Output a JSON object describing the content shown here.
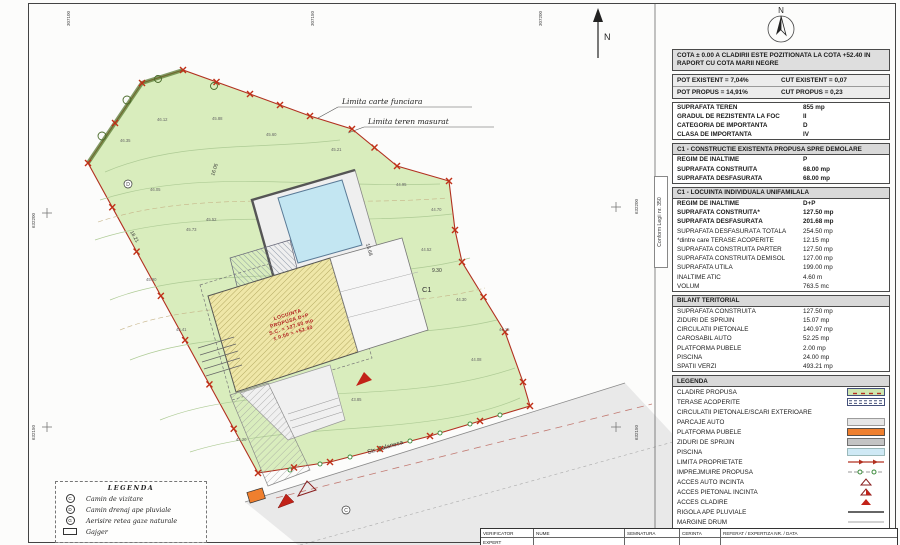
{
  "plan": {
    "north_label": "N",
    "labels": {
      "limita_carte_funciara": "Limita carte funciara",
      "limita_teren_masurat": "Limita teren masurat",
      "street_name": "Str. Balanesa",
      "building_id": "C1"
    },
    "building_annotation": [
      "LOCUINTA",
      "PROPUSA D+P",
      "S.C. = 127.50 mp",
      "± 0.00 = +52.40"
    ],
    "grid_labels": {
      "top": [
        "307100",
        "307150",
        "307200"
      ],
      "left": [
        "632200",
        "632150"
      ],
      "right": [
        "632200",
        "632150"
      ]
    },
    "dimension_labels": [
      {
        "text": "16.05",
        "x": 214,
        "y": 176,
        "rot": -72
      },
      {
        "text": "18.21",
        "x": 130,
        "y": 232,
        "rot": 60
      },
      {
        "text": "15.68",
        "x": 366,
        "y": 244,
        "rot": 74
      },
      {
        "text": "9.30",
        "x": 432,
        "y": 272,
        "rot": 0
      }
    ],
    "spot_elevations": [
      {
        "x": 120,
        "y": 142,
        "v": "46.35"
      },
      {
        "x": 157,
        "y": 121,
        "v": "46.12"
      },
      {
        "x": 212,
        "y": 120,
        "v": "45.88"
      },
      {
        "x": 266,
        "y": 136,
        "v": "45.60"
      },
      {
        "x": 331,
        "y": 151,
        "v": "45.21"
      },
      {
        "x": 396,
        "y": 186,
        "v": "44.95"
      },
      {
        "x": 431,
        "y": 211,
        "v": "44.70"
      },
      {
        "x": 150,
        "y": 191,
        "v": "46.05"
      },
      {
        "x": 186,
        "y": 231,
        "v": "45.73"
      },
      {
        "x": 146,
        "y": 281,
        "v": "45.90"
      },
      {
        "x": 176,
        "y": 331,
        "v": "45.41"
      },
      {
        "x": 206,
        "y": 221,
        "v": "45.52"
      },
      {
        "x": 421,
        "y": 251,
        "v": "44.52"
      },
      {
        "x": 456,
        "y": 301,
        "v": "44.30"
      },
      {
        "x": 471,
        "y": 361,
        "v": "44.08"
      },
      {
        "x": 351,
        "y": 401,
        "v": "43.85"
      },
      {
        "x": 236,
        "y": 441,
        "v": "44.20"
      },
      {
        "x": 499,
        "y": 331,
        "v": "44.15"
      }
    ]
  },
  "side_note": "Conform Legii nr. 350",
  "panel": {
    "cota_note": "COTA ± 0.00 A CLADIRII ESTE POZITIONATA LA COTA +52.40 IN RAPORT CU COTA MARII NEGRE",
    "pot_cut": [
      [
        "POT EXISTENT = 7,04%",
        "CUT EXISTENT = 0,07"
      ],
      [
        "POT PROPUS = 14,91%",
        "CUT PROPUS = 0,23"
      ]
    ],
    "teren_table": [
      {
        "label": "SUPRAFATA TEREN",
        "value": "855 mp"
      },
      {
        "label": "GRADUL DE REZISTENTA LA FOC",
        "value": "II"
      },
      {
        "label": "CATEGORIA DE IMPORTANTA",
        "value": "D"
      },
      {
        "label": "CLASA DE IMPORTANTA",
        "value": "IV"
      }
    ],
    "sections": [
      {
        "header": "C1 - CONSTRUCTIE EXISTENTA PROPUSA SPRE DEMOLARE",
        "rows": [
          {
            "label": "REGIM DE INALTIME",
            "value": "P",
            "bold": true
          },
          {
            "label": "SUPRAFATA CONSTRUITĂ",
            "value": "68.00 mp",
            "bold": true
          },
          {
            "label": "SUPRAFATA DESFASURATA",
            "value": "68.00 mp",
            "bold": true
          }
        ]
      },
      {
        "header": "C1 - LOCUINTA INDIVIDUALA UNIFAMILALA",
        "rows": [
          {
            "label": "REGIM DE INALTIME",
            "value": "D+P",
            "bold": true
          },
          {
            "label": "SUPRAFATA CONSTRUITĂ*",
            "value": "127.50 mp",
            "bold": true
          },
          {
            "label": "SUPRAFATA DESFASURATĂ",
            "value": "201.68 mp",
            "bold": true
          },
          {
            "label": "SUPRAFATA DESFASURATĂ TOTALA",
            "value": "254.50 mp",
            "bold": false
          },
          {
            "label": "*dintre care TERASE ACOPERITE",
            "value": "12.15 mp",
            "bold": false
          },
          {
            "label": "SUPRAFATA CONSTRUITA PARTER",
            "value": "127.50 mp",
            "bold": false
          },
          {
            "label": "SUPRAFATA CONSTRUITA DEMISOL",
            "value": "127.00 mp",
            "bold": false
          },
          {
            "label": "SUPRAFATA UTILĂ",
            "value": "199.00 mp",
            "bold": false
          },
          {
            "label": "INALTIME ATIC",
            "value": "4.60 m",
            "bold": false
          },
          {
            "label": "VOLUM",
            "value": "763.5 mc",
            "bold": false
          }
        ]
      },
      {
        "header": "BILANT TERITORIAL",
        "rows": [
          {
            "label": "SUPRAFATA CONSTRUITĂ",
            "value": "127.50 mp",
            "bold": false
          },
          {
            "label": "ZIDURI DE SPRIJIN",
            "value": "15.07 mp",
            "bold": false
          },
          {
            "label": "CIRCULATII PIETONALE",
            "value": "140.97 mp",
            "bold": false
          },
          {
            "label": "CAROSABIL AUTO",
            "value": "52.25 mp",
            "bold": false
          },
          {
            "label": "PLATFORMA PUBELE",
            "value": "2.00 mp",
            "bold": false
          },
          {
            "label": "PISCINĂ",
            "value": "24.00 mp",
            "bold": false
          },
          {
            "label": "SPATII VERZI",
            "value": "493.21 mp",
            "bold": false
          }
        ]
      }
    ],
    "legend": {
      "header": "LEGENDA",
      "items": [
        {
          "label": "CLADIRE PROPUSĂ",
          "swatch": "building"
        },
        {
          "label": "TERASE ACOPERITE",
          "swatch": "stripes"
        },
        {
          "label": "CIRCULATII PIETONALE/SCĂRI EXTERIOARE",
          "swatch": "none"
        },
        {
          "label": "PARCAJE AUTO",
          "swatch": "gray-light"
        },
        {
          "label": "PLATFORMA PUBELE",
          "swatch": "orange"
        },
        {
          "label": "ZIDURI DE SPRIJIN",
          "swatch": "gray"
        },
        {
          "label": "PISCINĂ",
          "swatch": "blue"
        },
        {
          "label": "LIMITĂ PROPRIETATE",
          "swatch": "limit-line"
        },
        {
          "label": "IMPREJMUIRE PROPUSĂ",
          "swatch": "fence-line"
        },
        {
          "label": "ACCES AUTO INCINTA",
          "swatch": "tri-open"
        },
        {
          "label": "ACCES PIETONAL INCINTA",
          "swatch": "tri-half"
        },
        {
          "label": "ACCES CLADIRE",
          "swatch": "tri-filled"
        },
        {
          "label": "RIGOLA APE PLUVIALE",
          "swatch": "line-dark"
        },
        {
          "label": "MARGINE DRUM",
          "swatch": "line-thin"
        },
        {
          "label": "AX DRUM",
          "swatch": "line-dashdot"
        }
      ]
    }
  },
  "plan_legend_box": {
    "title": "LEGENDA",
    "items": [
      {
        "symbol": "C",
        "label": "Camin de vizitare"
      },
      {
        "symbol": "D",
        "label": "Camin drenaj ape pluviale"
      },
      {
        "symbol": "G",
        "label": "Aerisire retea gaze naturale"
      },
      {
        "symbol": "rect",
        "label": "Gajger"
      }
    ]
  },
  "title_block": {
    "rows": [
      {
        "cells": [
          "VERIFICATOR",
          "NUME",
          "SEMNATURA",
          "CERINTA",
          "REFERAT / EXPERTIZA NR. / DATA"
        ]
      },
      {
        "cells": [
          "EXPERT",
          "",
          "",
          "",
          ""
        ]
      }
    ]
  },
  "colors": {
    "parcel_green": "#d9edbd",
    "boundary_red": "#b23020",
    "pool_blue": "#c3e6f2",
    "construction_yellow": "#efe7a8",
    "pubele_orange": "#ef7f2e",
    "road_gray": "#e9e9e9",
    "header_gray": "#d9d9d9"
  }
}
